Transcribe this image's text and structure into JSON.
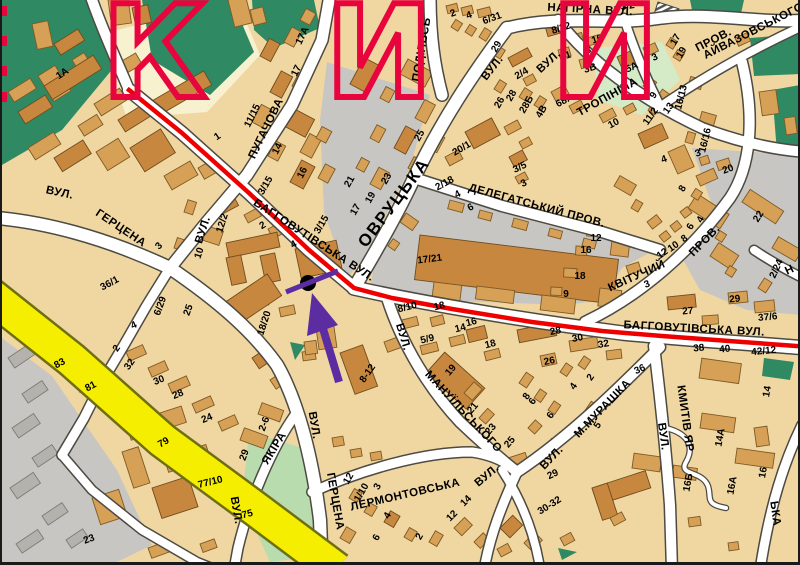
{
  "map_title": "Kyiv street map fragment (Tatarka district)",
  "colors": {
    "block_beige": "#f0d7a2",
    "block_pale": "#f8f1d0",
    "building_tan": "#d7a057",
    "building_dark": "#c8873f",
    "industrial_gray": "#c7c6c2",
    "park_dark_green": "#2f8a63",
    "park_light_green": "#b8dcae",
    "park_pale_green": "#d5eac6",
    "road_fill": "#ffffff",
    "road_casing": "#4c4a42",
    "highway_yellow": "#f6ee00",
    "route_red": "#ee0000",
    "watermark_red": "#e8043c",
    "arrow_purple": "#5c2da0",
    "label_black": "#000000"
  },
  "route": {
    "color": "#ee0000"
  },
  "marker": {
    "dot_color": "#000000",
    "arrow_color": "#5c2da0"
  },
  "watermark": {
    "color": "#e8043c",
    "letters": [
      [
        "К",
        152
      ],
      [
        "И",
        377
      ],
      [
        "И",
        603
      ]
    ]
  },
  "streets": [
    "ВУЛ. ГЕРЦЕНА",
    "ВУЛ. ПУГАЧОВА",
    "БАГГОВУТІВСЬКА ВУЛ.",
    "ОВРУЦЬКА ВУЛ.",
    "НАГІРНА ВУЛ.",
    "ВУЛ. ТРОПІНІНА",
    "ПРОВ. АЙВАЗОВСЬКОГО",
    "ДЕЛЕГАТСЬКИЙ ПРОВ.",
    "КВІТУЧИЙ ПРОВ.",
    "ВУЛ. МАНУЇЛЬСЬКОГО",
    "ЛЕРМОНТОВСЬКА ВУЛ.",
    "ВУЛ. М.МУРАШКА",
    "ВУЛ. КМИТІВ ЯР",
    "ВУЛ. ЯКІРА",
    "ПОДІЛЬСЬ…"
  ],
  "labels": [
    [
      "ВУЛ.",
      57,
      196,
      12,
      "s"
    ],
    [
      "ГЕРЦЕНА",
      117,
      231,
      34,
      "s"
    ],
    [
      "ВУЛ.",
      204,
      231,
      -72,
      "s"
    ],
    [
      "ПУГАЧОВА",
      267,
      130,
      -64,
      "s"
    ],
    [
      "БАГГОВУТІВСЬКА ВУЛ.",
      310,
      243,
      33,
      "s"
    ],
    [
      "ОВРУЦЬКА",
      396,
      206,
      -53,
      "S"
    ],
    [
      "ПОДІЛЬСЬ",
      423,
      50,
      -80,
      "s"
    ],
    [
      "ВУЛ.",
      493,
      70,
      -52,
      "s"
    ],
    [
      "НАГІРНА ВУЛ.",
      588,
      13,
      3,
      "s"
    ],
    [
      "ДЕЛЕГАТСЬКИЙ ПРОВ.",
      534,
      209,
      15,
      "s"
    ],
    [
      "КВІТУЧИЙ",
      636,
      279,
      -24,
      "s"
    ],
    [
      "ПРОВ.",
      705,
      243,
      -46,
      "s"
    ],
    [
      "ВУЛ.",
      549,
      64,
      -42,
      "s"
    ],
    [
      "ТРОПІНІНА",
      607,
      100,
      -29,
      "s"
    ],
    [
      "ПРОВ.",
      713,
      43,
      -27,
      "s"
    ],
    [
      "АЙВАЗОВСЬКОГО",
      753,
      34,
      -27,
      "s"
    ],
    [
      "БАГГОВУТІВСЬКА ВУЛ.",
      692,
      332,
      3,
      "s"
    ],
    [
      "ВУЛ.",
      398,
      338,
      73,
      "s"
    ],
    [
      "МАНУЇЛЬСЬКОГО",
      459,
      414,
      47,
      "s"
    ],
    [
      "ВУЛ.",
      309,
      426,
      80,
      "s"
    ],
    [
      "ГЕРЦЕНА",
      330,
      502,
      80,
      "s"
    ],
    [
      "ЛЕРМОНТОВСЬКА",
      404,
      498,
      -13,
      "s"
    ],
    [
      "ВУЛ.",
      487,
      478,
      -40,
      "s"
    ],
    [
      "ВУЛ.",
      552,
      460,
      -46,
      "s"
    ],
    [
      "М.МУРАШКА",
      603,
      411,
      -46,
      "s"
    ],
    [
      "ВУЛ.",
      658,
      437,
      82,
      "s"
    ],
    [
      "КМИТІВ ЯР",
      680,
      419,
      82,
      "s"
    ],
    [
      "ВУЛ.",
      231,
      511,
      80,
      "s"
    ],
    [
      "ЯКІРА",
      275,
      450,
      -58,
      "s"
    ],
    [
      "ЬКА",
      770,
      514,
      82,
      "s"
    ],
    [
      "Н",
      789,
      273,
      -25,
      "s"
    ],
    [
      "1А",
      62,
      76,
      -33,
      "n"
    ],
    [
      "1",
      217,
      139,
      -33,
      "n"
    ],
    [
      "11/15",
      253,
      117,
      -64,
      "n"
    ],
    [
      "17А",
      303,
      37,
      -64,
      "n"
    ],
    [
      "17",
      297,
      72,
      -64,
      "n"
    ],
    [
      "14",
      278,
      150,
      -64,
      "n"
    ],
    [
      "16",
      303,
      174,
      -64,
      "n"
    ],
    [
      "3/15",
      266,
      187,
      -60,
      "n"
    ],
    [
      "3/15",
      322,
      226,
      -60,
      "n"
    ],
    [
      "21",
      350,
      183,
      -60,
      "n"
    ],
    [
      "23",
      387,
      180,
      -60,
      "n"
    ],
    [
      "17",
      356,
      211,
      -60,
      "n"
    ],
    [
      "19",
      371,
      199,
      -60,
      "n"
    ],
    [
      "25",
      420,
      137,
      -60,
      "n"
    ],
    [
      "2",
      452,
      16,
      -20,
      "n"
    ],
    [
      "4",
      468,
      18,
      -20,
      "n"
    ],
    [
      "6/31",
      491,
      21,
      -20,
      "n"
    ],
    [
      "29",
      497,
      48,
      -60,
      "n"
    ],
    [
      "2/4",
      521,
      76,
      -30,
      "n"
    ],
    [
      "26",
      500,
      104,
      -60,
      "n"
    ],
    [
      "28",
      512,
      97,
      -60,
      "n"
    ],
    [
      "28Б",
      527,
      106,
      -60,
      "n"
    ],
    [
      "4В",
      542,
      113,
      -60,
      "n"
    ],
    [
      "20/1",
      461,
      151,
      -30,
      "n"
    ],
    [
      "3/5",
      519,
      170,
      -25,
      "n"
    ],
    [
      "3",
      523,
      186,
      -25,
      "n"
    ],
    [
      "2/18",
      444,
      186,
      -28,
      "n"
    ],
    [
      "4",
      457,
      197,
      -28,
      "n"
    ],
    [
      "6",
      470,
      210,
      -28,
      "n"
    ],
    [
      "8/32",
      560,
      31,
      -18,
      "n"
    ],
    [
      "10",
      596,
      42,
      -18,
      "n"
    ],
    [
      "8",
      587,
      53,
      -18,
      "n"
    ],
    [
      "1",
      567,
      58,
      -18,
      "n"
    ],
    [
      "3В",
      589,
      71,
      -18,
      "n"
    ],
    [
      "5А",
      631,
      70,
      -25,
      "n"
    ],
    [
      "3",
      654,
      60,
      -25,
      "n"
    ],
    [
      "68А",
      564,
      103,
      -28,
      "n"
    ],
    [
      "10",
      613,
      126,
      -28,
      "n"
    ],
    [
      "9",
      654,
      97,
      -55,
      "n"
    ],
    [
      "13",
      669,
      110,
      -55,
      "n"
    ],
    [
      "11/2",
      651,
      118,
      -55,
      "n"
    ],
    [
      "17",
      676,
      41,
      -60,
      "n"
    ],
    [
      "19",
      682,
      54,
      -60,
      "n"
    ],
    [
      "16/13",
      682,
      98,
      -76,
      "n"
    ],
    [
      "16/16",
      706,
      141,
      -76,
      "n"
    ],
    [
      "3",
      697,
      156,
      -20,
      "n"
    ],
    [
      "4",
      663,
      162,
      -20,
      "n"
    ],
    [
      "20",
      727,
      172,
      -20,
      "n"
    ],
    [
      "3/2",
      626,
      9,
      -8,
      "n"
    ],
    [
      "12/2",
      223,
      224,
      -72,
      "n"
    ],
    [
      "2",
      262,
      228,
      -30,
      "n"
    ],
    [
      "4",
      293,
      247,
      -30,
      "n"
    ],
    [
      "10",
      200,
      254,
      -72,
      "n"
    ],
    [
      "3",
      159,
      248,
      -45,
      "n"
    ],
    [
      "36/1",
      109,
      286,
      -28,
      "n"
    ],
    [
      "6/29",
      161,
      307,
      -70,
      "n"
    ],
    [
      "25",
      189,
      311,
      -70,
      "n"
    ],
    [
      "4",
      133,
      328,
      -25,
      "n"
    ],
    [
      "2",
      117,
      350,
      -55,
      "n"
    ],
    [
      "32",
      130,
      366,
      -55,
      "n"
    ],
    [
      "18/20",
      265,
      324,
      -72,
      "n"
    ],
    [
      "17/21",
      428,
      262,
      -7,
      "n"
    ],
    [
      "12",
      594,
      241,
      0,
      "n"
    ],
    [
      "16",
      584,
      253,
      0,
      "n"
    ],
    [
      "18",
      578,
      279,
      0,
      "n"
    ],
    [
      "9",
      564,
      297,
      0,
      "n"
    ],
    [
      "8/10",
      406,
      310,
      -14,
      "n"
    ],
    [
      "18",
      438,
      309,
      -14,
      "n"
    ],
    [
      "16",
      470,
      325,
      -14,
      "n"
    ],
    [
      "14",
      459,
      331,
      -14,
      "n"
    ],
    [
      "5/9",
      426,
      342,
      -14,
      "n"
    ],
    [
      "18",
      489,
      347,
      -14,
      "n"
    ],
    [
      "28",
      554,
      334,
      -10,
      "n"
    ],
    [
      "30",
      576,
      341,
      -10,
      "n"
    ],
    [
      "32",
      602,
      347,
      -10,
      "n"
    ],
    [
      "26",
      548,
      364,
      -12,
      "n"
    ],
    [
      "19",
      451,
      372,
      -50,
      "n"
    ],
    [
      "21",
      473,
      410,
      -50,
      "n"
    ],
    [
      "23",
      491,
      431,
      -50,
      "n"
    ],
    [
      "25",
      510,
      444,
      -50,
      "n"
    ],
    [
      "8",
      527,
      398,
      -55,
      "n"
    ],
    [
      "4",
      574,
      388,
      -55,
      "n"
    ],
    [
      "2",
      591,
      379,
      -55,
      "n"
    ],
    [
      "6",
      533,
      403,
      -55,
      "n"
    ],
    [
      "6",
      551,
      417,
      -55,
      "n"
    ],
    [
      "5",
      598,
      427,
      -55,
      "n"
    ],
    [
      "29",
      552,
      477,
      -25,
      "n"
    ],
    [
      "30-32",
      549,
      508,
      -32,
      "n"
    ],
    [
      "36",
      639,
      372,
      -25,
      "n"
    ],
    [
      "12",
      662,
      256,
      -35,
      "n"
    ],
    [
      "10",
      673,
      249,
      -35,
      "n"
    ],
    [
      "8",
      684,
      241,
      -35,
      "n"
    ],
    [
      "8",
      683,
      190,
      -60,
      "n"
    ],
    [
      "6",
      691,
      228,
      -60,
      "n"
    ],
    [
      "4",
      701,
      221,
      -60,
      "n"
    ],
    [
      "3",
      646,
      287,
      -20,
      "n"
    ],
    [
      "22",
      759,
      218,
      -58,
      "n"
    ],
    [
      "2/24",
      777,
      270,
      -65,
      "n"
    ],
    [
      "29",
      733,
      302,
      -5,
      "n"
    ],
    [
      "27",
      686,
      314,
      -5,
      "n"
    ],
    [
      "37/6",
      766,
      320,
      -5,
      "n"
    ],
    [
      "38",
      697,
      351,
      -5,
      "n"
    ],
    [
      "40",
      723,
      352,
      -5,
      "n"
    ],
    [
      "42/12",
      762,
      354,
      -5,
      "n"
    ],
    [
      "14",
      768,
      392,
      -80,
      "n"
    ],
    [
      "14А",
      721,
      438,
      -80,
      "n"
    ],
    [
      "16",
      764,
      473,
      -80,
      "n"
    ],
    [
      "16А",
      733,
      486,
      -80,
      "n"
    ],
    [
      "16Б",
      689,
      483,
      -80,
      "n"
    ],
    [
      "83",
      59,
      366,
      -28,
      "n"
    ],
    [
      "81",
      90,
      389,
      -28,
      "n"
    ],
    [
      "30",
      158,
      383,
      -22,
      "n"
    ],
    [
      "28",
      177,
      397,
      -22,
      "n"
    ],
    [
      "24",
      206,
      421,
      -22,
      "n"
    ],
    [
      "79",
      163,
      445,
      -30,
      "n"
    ],
    [
      "29",
      245,
      456,
      -70,
      "n"
    ],
    [
      "2-6",
      265,
      425,
      -70,
      "n"
    ],
    [
      "77/10",
      209,
      485,
      -14,
      "n"
    ],
    [
      "75",
      246,
      517,
      -14,
      "n"
    ],
    [
      "23",
      88,
      542,
      -20,
      "n"
    ],
    [
      "8-12",
      368,
      375,
      -55,
      "n"
    ],
    [
      "12",
      349,
      480,
      -60,
      "n"
    ],
    [
      "1/10",
      362,
      494,
      -60,
      "n"
    ],
    [
      "3",
      378,
      488,
      -60,
      "n"
    ],
    [
      "4",
      388,
      517,
      -60,
      "n"
    ],
    [
      "6",
      377,
      539,
      -60,
      "n"
    ],
    [
      "2",
      420,
      538,
      -60,
      "n"
    ],
    [
      "12",
      452,
      518,
      -45,
      "n"
    ],
    [
      "14",
      466,
      503,
      -45,
      "n"
    ]
  ]
}
